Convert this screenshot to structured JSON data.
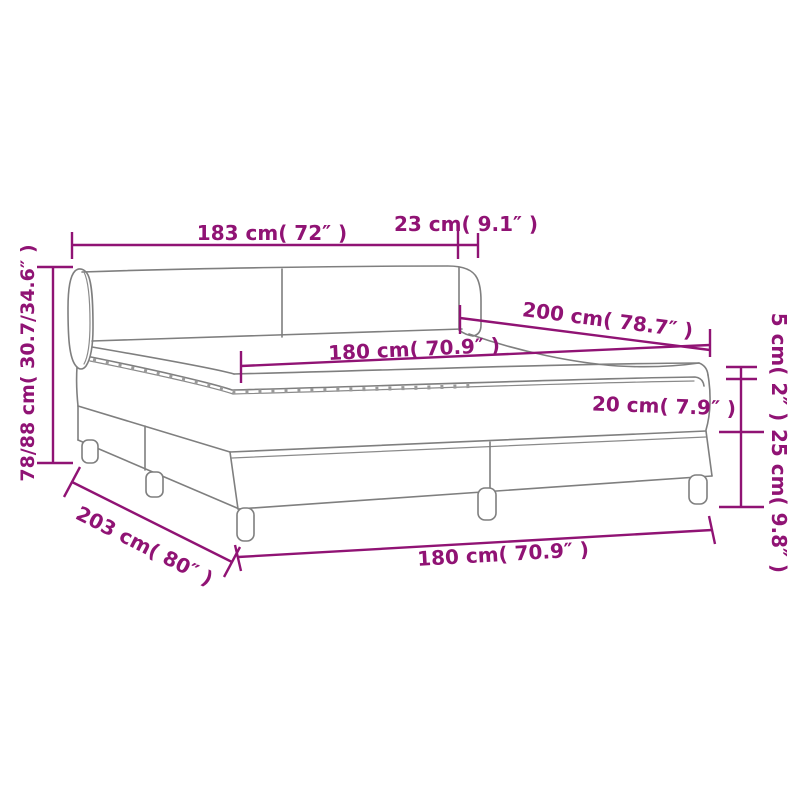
{
  "diagram": {
    "type": "product-dimension-diagram",
    "subject": "box-spring-bed",
    "colors": {
      "dimension_annotation": "#901374",
      "bed_outline": "#7f7f7f",
      "background": "#ffffff"
    },
    "labels": {
      "headboard_width": "183 cm( 72″ )",
      "wing_depth": "23 cm( 9.1″ )",
      "bed_length": "200 cm( 78.7″ )",
      "mattress_width": "180 cm( 70.9″ )",
      "pillowtop_height": "5 cm( 2″ )",
      "mattress_height": "20 cm( 7.9″ )",
      "base_height": "25 cm( 9.8″ )",
      "headboard_height": "78/88 cm( 30.7/34.6″ )",
      "total_length": "203 cm( 80″ )",
      "base_width": "180 cm( 70.9″ )"
    }
  }
}
